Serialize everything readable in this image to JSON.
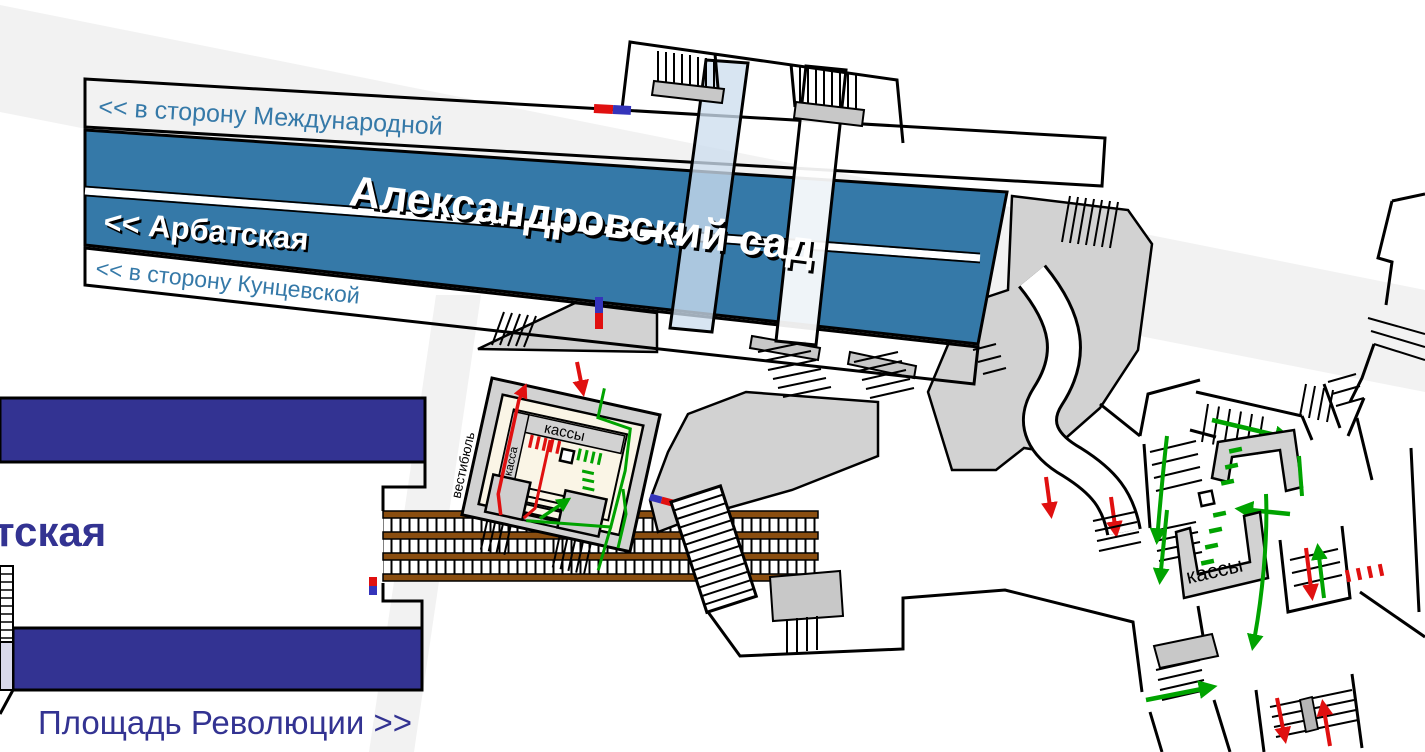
{
  "scheme": {
    "station_title": "Александровский сад",
    "filyovskaya_line": {
      "direction_top": "<< в сторону Международной",
      "neighbor_station": "<< Арбатская",
      "direction_bottom": "<< в сторону Кунцевской"
    },
    "arbatskaya_line": {
      "station_partial": "тская",
      "direction": "Площадь Революции >>"
    },
    "central_vestibule": {
      "vestibule": "вестибюль",
      "ticket_windows": "кассы",
      "ticket_window": "касса"
    },
    "east_vestibule": {
      "ticket_windows": "кассы"
    },
    "colors": {
      "filyovskaya_blue": "#3579a8",
      "arbatskaya_navy": "#333392",
      "corridor_gray": "#d2d2d2",
      "track_brown": "#8a4e10",
      "flow_red": "#e01010",
      "flow_green": "#00a300",
      "gate_blue": "#3434bb",
      "street_gray": "#f2f2f2",
      "hall_cream": "#faf5e6",
      "exit_lavender": "#d8d8ea"
    }
  }
}
